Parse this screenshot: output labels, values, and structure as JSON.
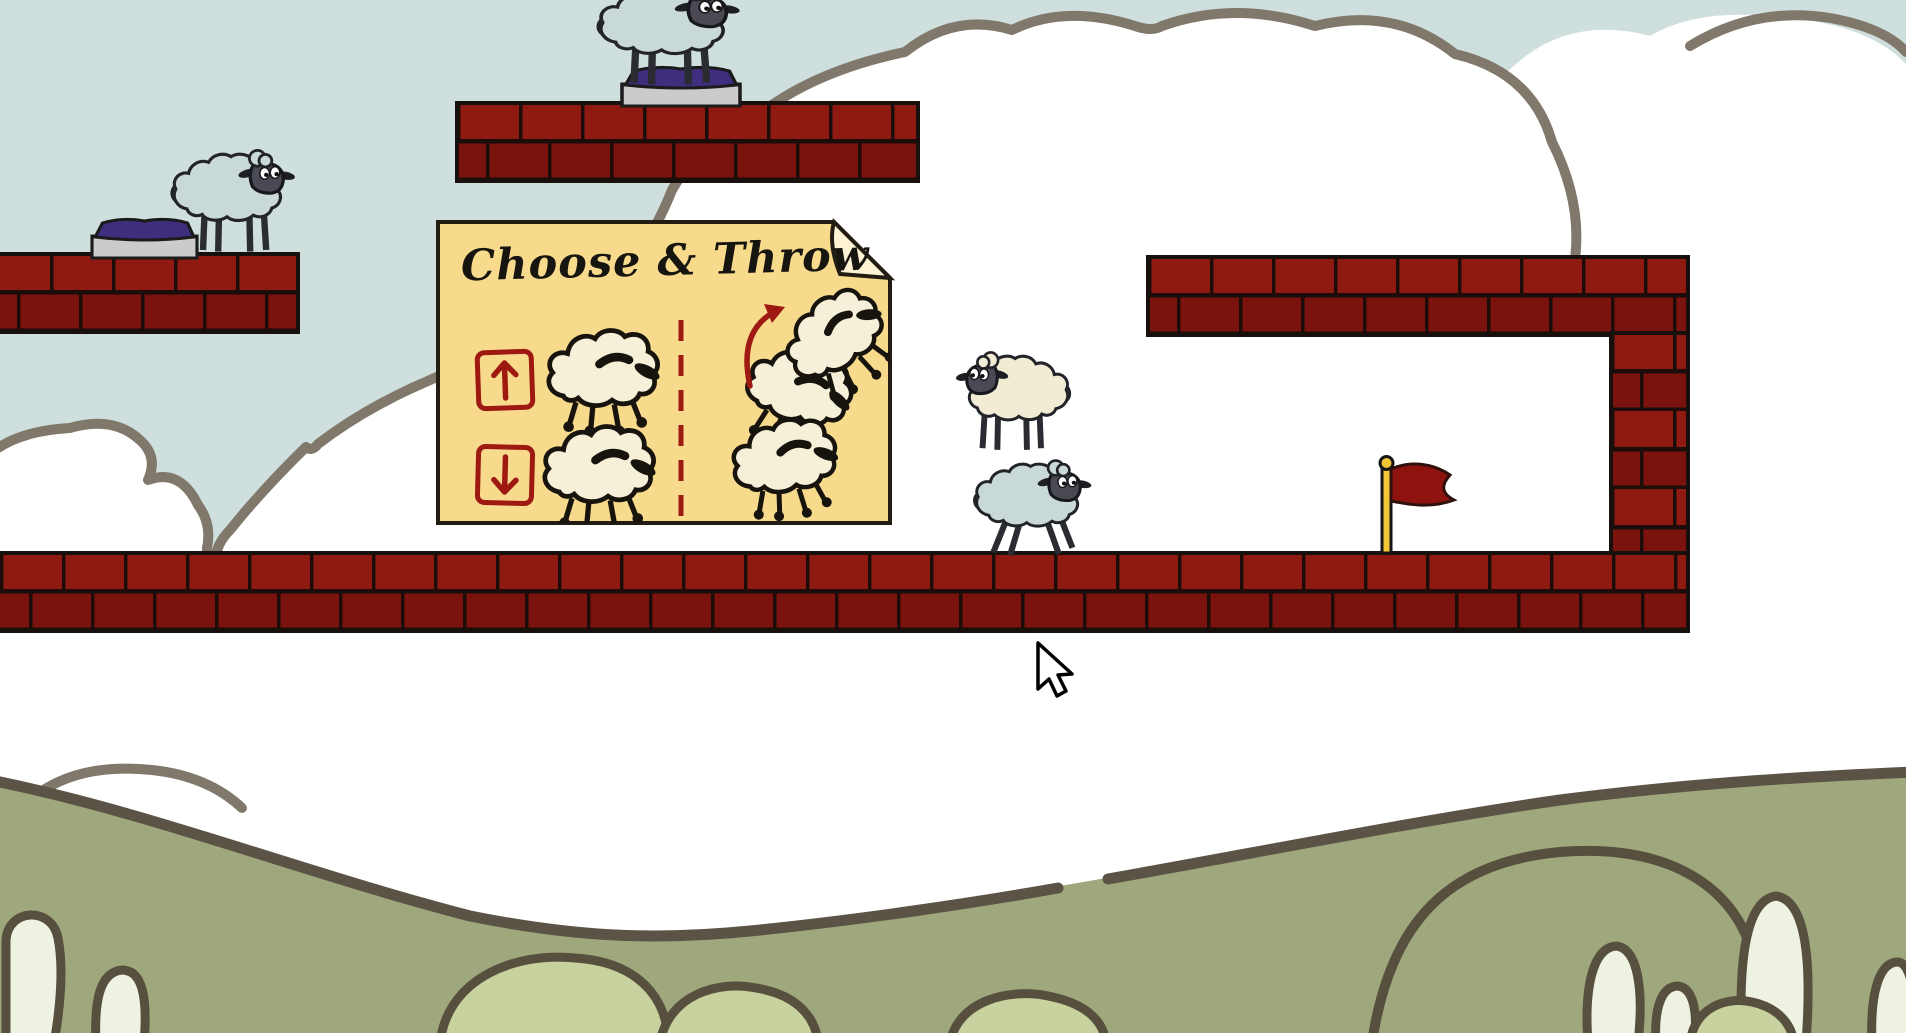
{
  "scene": {
    "instruction_card": {
      "title": "Choose & Throw",
      "up_button_icon": "arrow-up-icon",
      "down_button_icon": "arrow-down-icon",
      "divider_style": "red-dashed-vertical",
      "throw_illustration_icon": "throw-arc-arrow-icon"
    },
    "entities": {
      "sheep": [
        {
          "id": "sheep-top-platform",
          "wool": "#c9d8d8",
          "pose": "standing",
          "facing": "right",
          "location": "on cushion, upper middle platform"
        },
        {
          "id": "sheep-left-platform",
          "wool": "#c9d8d8",
          "pose": "standing",
          "facing": "right",
          "location": "left brick platform"
        },
        {
          "id": "sheep-airborne-cream",
          "wool": "#f2ecd4",
          "pose": "standing",
          "facing": "left",
          "location": "mid-air above ground floor"
        },
        {
          "id": "sheep-ground-blue",
          "wool": "#c9d8d8",
          "pose": "running",
          "facing": "right",
          "location": "ground floor"
        }
      ],
      "goal_flag": {
        "pole_color": "#f3c636",
        "cloth_color": "#8e130e"
      },
      "cushions": [
        {
          "id": "cushion-left",
          "top_color": "#3f2d7e",
          "base_color": "#cbcbcb"
        },
        {
          "id": "cushion-top",
          "top_color": "#3f2d7e",
          "base_color": "#cbcbcb"
        }
      ],
      "platforms": [
        "left-platform",
        "top-middle-platform",
        "right-beam",
        "right-column",
        "ground-floor"
      ]
    },
    "colors": {
      "sky": "#cfdfdd",
      "cloud_fill": "#ffffff",
      "cloud_outline": "#7f786b",
      "brick_light": "#8e1a12",
      "brick_dark": "#7a130d",
      "mortar": "#1c0d0a",
      "card_fill": "#f8da8c",
      "accent_red": "#9e1912",
      "hill_fill": "#9fa87c",
      "hill_outline": "#5b5346",
      "bush_fill": "#c8d29e",
      "tree_fill": "#eef2e3"
    },
    "cursor": {
      "icon": "mouse-arrow-cursor",
      "x": 1038,
      "y": 643
    }
  }
}
